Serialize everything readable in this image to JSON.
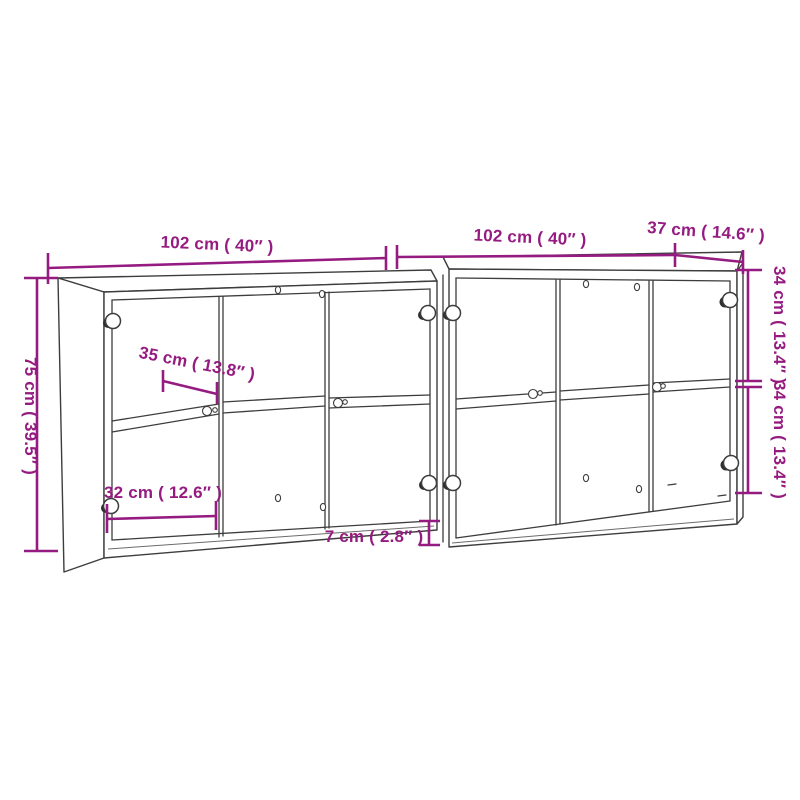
{
  "page": {
    "background_color": "#ffffff"
  },
  "diagram": {
    "accent_color": "#951b81",
    "line_color": "#3d3d3d",
    "dimensions": {
      "overall_width_left_section": "102 cm ( 40″ )",
      "overall_width_right_section": "102 cm ( 40″ )",
      "depth": "37 cm ( 14.6″ )",
      "overall_height": "75 cm ( 39.5″ )",
      "shelf_depth": "35 cm ( 13.8″ )",
      "compartment_width": "32 cm ( 12.6″ )",
      "plinth_height": "7 cm ( 2.8″ )",
      "upper_compartment_height": "34 cm ( 13.4″ )",
      "lower_compartment_height": "34 cm ( 13.4″ )"
    }
  }
}
